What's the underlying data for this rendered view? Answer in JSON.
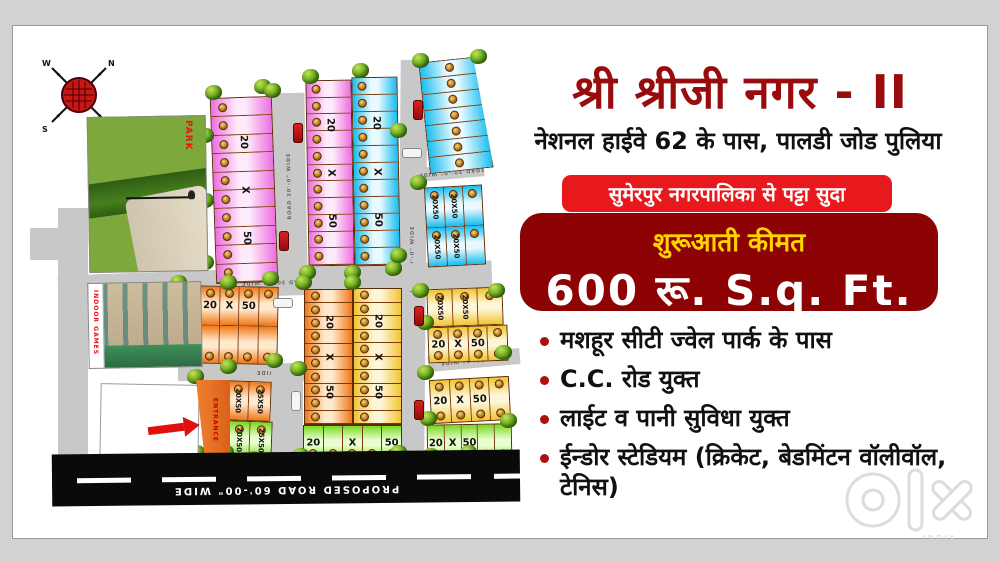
{
  "header": {
    "title": "श्री श्रीजी नगर - II",
    "subtitle": "नेशनल हाईवे 62 के पास, पालडी जोड पुलिया",
    "title_color": "#9a0b0e"
  },
  "banners": {
    "lease": {
      "text": "सुमेरपुर नगरपालिका से पट्टा सुदा",
      "bg": "#e8191c"
    },
    "price": {
      "label": "शुरूआती कीमत",
      "label_color": "#ffd400",
      "value": "600 रू. S.q.  Ft.",
      "bg": "#8d0304"
    }
  },
  "features": [
    "मशहूर सीटी ज्वेल पार्क के पास",
    "C.C. रोड युक्त",
    "लाईट व पानी सुविधा युक्त",
    "ईन्डोर स्टेडियम (क्रिकेट, बेडमिंटन वॉलीवॉल, टेनिस)"
  ],
  "watermark": {
    "brand": "OLX",
    "country": "INDIA"
  },
  "map": {
    "park_label": "PARK",
    "indoor_label": "INDOOR GAMES",
    "entrance_label": "ENTRANCE",
    "road_label": "ROAD 30'-0\" WIDE",
    "main_road_label": "PROPOSED ROAD  60'-00\" WIDE",
    "compass_directions": [
      "N",
      "E",
      "S",
      "W"
    ],
    "palettes": {
      "pink": {
        "base": "#ef6ee0",
        "light": "#fdeafb"
      },
      "blue": {
        "base": "#18bdf0",
        "light": "#e8faff"
      },
      "orange": {
        "base": "#f07818",
        "light": "#ffe9cd"
      },
      "yellow": {
        "base": "#f2c430",
        "light": "#fdf6d8"
      },
      "green": {
        "base": "#78d820",
        "light": "#e9ffd1"
      }
    },
    "groups": [
      {
        "kind": "strips",
        "x": 213,
        "y": 97,
        "w": 62,
        "h": 186,
        "rot": -2,
        "n": 10,
        "pal": "pink",
        "chars": [
          "20",
          "X",
          "50"
        ]
      },
      {
        "kind": "strips",
        "x": 307,
        "y": 80,
        "w": 46,
        "h": 186,
        "rot": -1,
        "n": 11,
        "pal": "pink",
        "chars": [
          "20",
          "X",
          "50"
        ]
      },
      {
        "kind": "strips",
        "x": 353,
        "y": 77,
        "w": 46,
        "h": 189,
        "rot": -1,
        "n": 11,
        "pal": "blue",
        "chars": [
          "20",
          "X",
          "50"
        ]
      },
      {
        "kind": "strips",
        "x": 424,
        "y": 59,
        "w": 64,
        "h": 112,
        "rot": -6,
        "n": 7,
        "pal": "blue",
        "chars": [],
        "clip": "polygon(0 0,86% 0,100% 100%,0 100%)",
        "embLeft": "40%"
      },
      {
        "kind": "grid",
        "x": 426,
        "y": 186,
        "w": 58,
        "h": 80,
        "rot": -3,
        "rows": 2,
        "cols": 3,
        "pal": "blue",
        "labels": [
          "20X50",
          "20X50",
          "",
          "20X50",
          "20X50",
          ""
        ]
      },
      {
        "kind": "cells",
        "x": 180,
        "y": 286,
        "w": 98,
        "h": 78,
        "rot": 1,
        "rows": 2,
        "cols": 5,
        "pal": "orange",
        "labels": [
          "",
          "20",
          "X",
          "50",
          ""
        ],
        "emb": "both"
      },
      {
        "kind": "strips",
        "x": 304,
        "y": 289,
        "w": 49,
        "h": 136,
        "rot": 0,
        "n": 10,
        "pal": "orange",
        "chars": [
          "20",
          "X",
          "50"
        ]
      },
      {
        "kind": "strips",
        "x": 353,
        "y": 288,
        "w": 49,
        "h": 137,
        "rot": 0,
        "n": 10,
        "pal": "yellow",
        "chars": [
          "20",
          "X",
          "50"
        ]
      },
      {
        "kind": "cells",
        "x": 303,
        "y": 425,
        "w": 99,
        "h": 36,
        "rot": 0,
        "rows": 1,
        "cols": 5,
        "pal": "green",
        "labels": [
          "20",
          "",
          "X",
          "",
          "50"
        ],
        "emb": "bottom"
      },
      {
        "kind": "grid",
        "x": 427,
        "y": 288,
        "w": 76,
        "h": 38,
        "rot": -2,
        "rows": 1,
        "cols": 3,
        "pal": "yellow",
        "labels": [
          "20X50",
          "20X50",
          ""
        ]
      },
      {
        "kind": "cells",
        "x": 428,
        "y": 326,
        "w": 80,
        "h": 36,
        "rot": -2,
        "rows": 1,
        "cols": 4,
        "pal": "yellow",
        "labels": [
          "20",
          "X",
          "50",
          ""
        ],
        "emb": "both"
      },
      {
        "kind": "cells",
        "x": 430,
        "y": 378,
        "w": 80,
        "h": 44,
        "rot": -3,
        "rows": 1,
        "cols": 4,
        "pal": "yellow",
        "labels": [
          "20",
          "X",
          "50",
          ""
        ],
        "emb": "both"
      },
      {
        "kind": "cells",
        "x": 427,
        "y": 424,
        "w": 85,
        "h": 38,
        "rot": -1,
        "rows": 1,
        "cols": 5,
        "pal": "green",
        "labels": [
          "20",
          "X",
          "50",
          ""
        ],
        "emb": "bottom"
      },
      {
        "kind": "grid",
        "x": 226,
        "y": 381,
        "w": 45,
        "h": 40,
        "rot": 2,
        "rows": 1,
        "cols": 2,
        "pal": "orange",
        "labels": [
          "20X50",
          "25X50"
        ]
      },
      {
        "kind": "grid",
        "x": 227,
        "y": 421,
        "w": 45,
        "h": 38,
        "rot": 2,
        "rows": 1,
        "cols": 2,
        "pal": "green",
        "labels": [
          "20X50",
          "25X50"
        ]
      }
    ],
    "roads": [
      {
        "x": 58,
        "y": 208,
        "w": 30,
        "h": 255,
        "rot": 0
      },
      {
        "x": 30,
        "y": 228,
        "w": 30,
        "h": 32,
        "rot": 0
      },
      {
        "x": 273,
        "y": 93,
        "w": 33,
        "h": 186,
        "rot": -1,
        "label": "v"
      },
      {
        "x": 399,
        "y": 60,
        "w": 27,
        "h": 398,
        "rot": 0.5,
        "label": "v"
      },
      {
        "x": 58,
        "y": 268,
        "w": 434,
        "h": 28,
        "rot": -2,
        "label": "h"
      },
      {
        "x": 178,
        "y": 363,
        "w": 224,
        "h": 18,
        "rot": 0,
        "label": "h"
      },
      {
        "x": 428,
        "y": 352,
        "w": 92,
        "h": 16,
        "rot": -5,
        "label": "h"
      },
      {
        "x": 271,
        "y": 368,
        "w": 32,
        "h": 92,
        "rot": 0
      },
      {
        "x": 420,
        "y": 165,
        "w": 64,
        "h": 14,
        "rot": -5,
        "label": "h"
      }
    ],
    "trees": [
      [
        213,
        92
      ],
      [
        262,
        86
      ],
      [
        310,
        76
      ],
      [
        360,
        70
      ],
      [
        420,
        60
      ],
      [
        478,
        56
      ],
      [
        205,
        135
      ],
      [
        205,
        200
      ],
      [
        205,
        262
      ],
      [
        272,
        90
      ],
      [
        270,
        278
      ],
      [
        307,
        272
      ],
      [
        352,
        272
      ],
      [
        393,
        268
      ],
      [
        398,
        130
      ],
      [
        418,
        182
      ],
      [
        398,
        255
      ],
      [
        420,
        290
      ],
      [
        178,
        282
      ],
      [
        178,
        358
      ],
      [
        228,
        282
      ],
      [
        228,
        366
      ],
      [
        274,
        360
      ],
      [
        195,
        376
      ],
      [
        196,
        452
      ],
      [
        225,
        452
      ],
      [
        303,
        282
      ],
      [
        298,
        368
      ],
      [
        352,
        282
      ],
      [
        300,
        455
      ],
      [
        345,
        458
      ],
      [
        398,
        452
      ],
      [
        425,
        322
      ],
      [
        425,
        372
      ],
      [
        428,
        418
      ],
      [
        496,
        290
      ],
      [
        503,
        352
      ],
      [
        508,
        420
      ],
      [
        215,
        452
      ],
      [
        252,
        458
      ],
      [
        430,
        455
      ],
      [
        468,
        452
      ],
      [
        488,
        460
      ],
      [
        110,
        450
      ]
    ],
    "cars": [
      {
        "x": 293,
        "y": 123,
        "type": "red",
        "dir": "v"
      },
      {
        "x": 279,
        "y": 231,
        "type": "red",
        "dir": "v"
      },
      {
        "x": 413,
        "y": 100,
        "type": "red",
        "dir": "v"
      },
      {
        "x": 402,
        "y": 148,
        "type": "white",
        "dir": "h"
      },
      {
        "x": 414,
        "y": 306,
        "type": "red",
        "dir": "v"
      },
      {
        "x": 414,
        "y": 400,
        "type": "red",
        "dir": "v"
      },
      {
        "x": 291,
        "y": 391,
        "type": "white",
        "dir": "v"
      },
      {
        "x": 273,
        "y": 298,
        "type": "white",
        "dir": "h"
      }
    ]
  }
}
